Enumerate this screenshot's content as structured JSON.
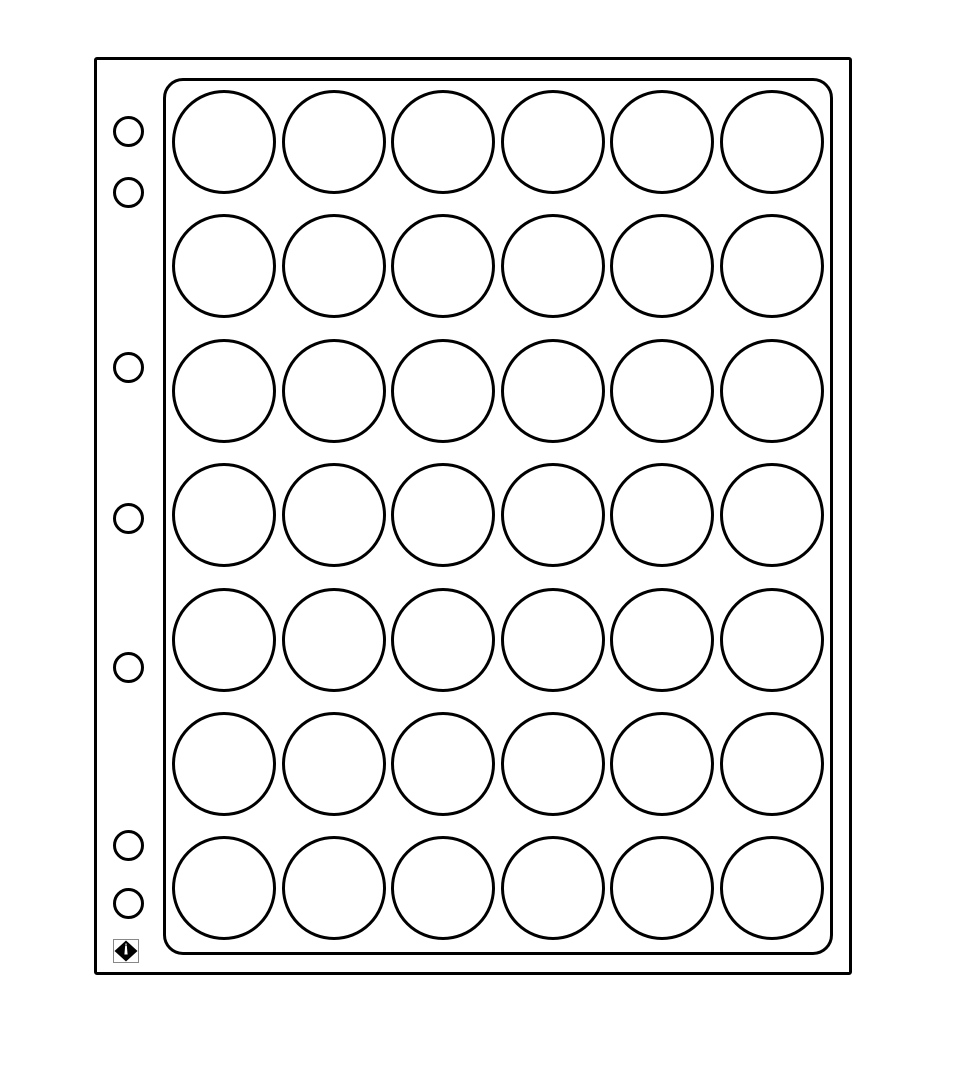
{
  "page": {
    "background": "#ffffff"
  },
  "sheet": {
    "type": "binder-sheet-with-round-pockets",
    "fill": "#ffffff",
    "stroke": "#000000",
    "pocket_grid": {
      "rows": 7,
      "columns": 6,
      "total_pockets": 42,
      "pocket_shape": "circle"
    },
    "binder_holes": {
      "count": 7,
      "arrangement_groups_top_to_bottom": [
        2,
        1,
        1,
        1,
        2
      ]
    },
    "logo": {
      "icon": "lighthouse-diamond-logo",
      "color": "#000000"
    }
  }
}
